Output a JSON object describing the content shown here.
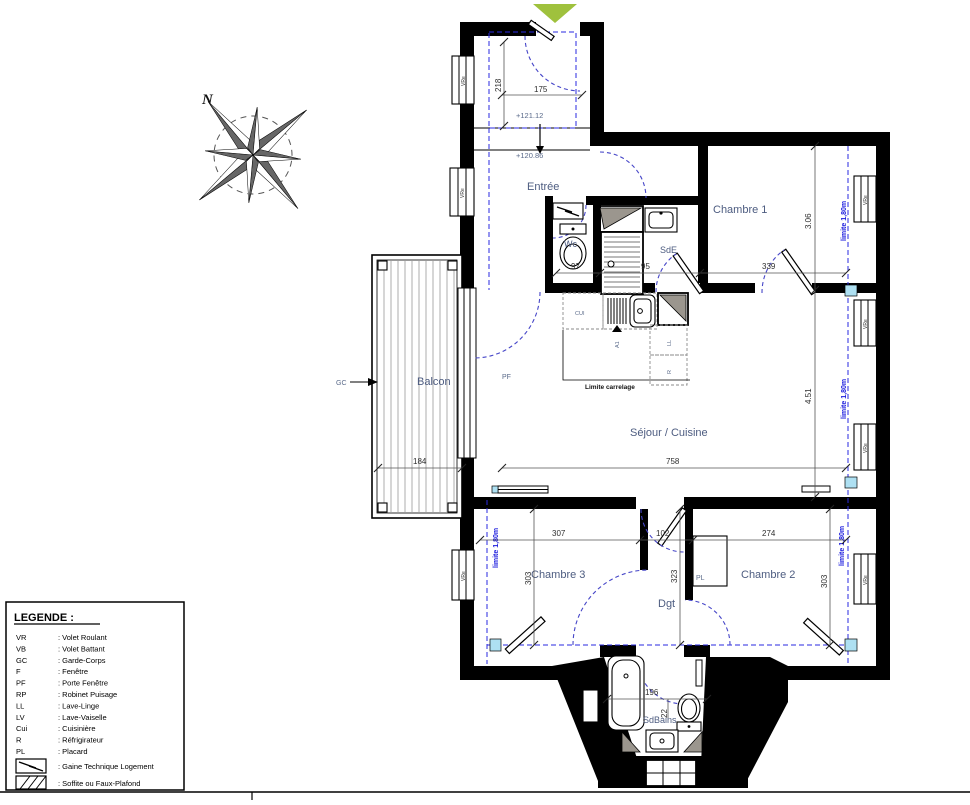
{
  "north": {
    "label": "N"
  },
  "colors": {
    "wall": "#000000",
    "room_label": "#4d5c80",
    "dimension_text": "#2e2e2e",
    "limite_blue": "#1818dd",
    "door_arc_blue": "#4646c8",
    "entrance_arrow_green": "#9fc13d",
    "soffite_gray": "#9b968e",
    "radiator_marker_blue": "#aee0f2"
  },
  "rooms": {
    "entree": "Entrée",
    "chambre1": "Chambre 1",
    "chambre2": "Chambre 2",
    "chambre3": "Chambre 3",
    "sejour": "Séjour / Cuisine",
    "sde": "SdE",
    "wc": "Wc",
    "sdbains": "SdBains",
    "balcon": "Balcon",
    "dgt": "Dgt"
  },
  "levels": {
    "upper": "+121.12",
    "lower": "+120.86"
  },
  "dims": {
    "entry_depth": "218",
    "entry_width": "175",
    "wc_width": "97",
    "shower_width": "95",
    "ch1_width": "339",
    "ch1_depth": "3.06",
    "sejour_width": "758",
    "sejour_depth": "4.51",
    "balcon_width": "184",
    "ch3_width": "307",
    "dgt_width": "102",
    "ch2_width": "274",
    "ch3_depth": "303",
    "dgt_depth": "323",
    "ch2_depth": "303",
    "sdb_width": "196",
    "sdb_toilet_gap": "22"
  },
  "annotations": {
    "gc": "GC",
    "pf": "PF",
    "window_shutter": "VRe",
    "cui": "CUI",
    "lave_linge": "LL",
    "refrigerateur": "R",
    "placard": "PL",
    "section_marker": "A1",
    "limite_carrelage": "Limite carrelage",
    "limite_180": "limite 1,80m"
  },
  "legend": {
    "title": "LEGENDE :",
    "items": [
      {
        "abbr": "VR",
        "label": ": Volet Roulant"
      },
      {
        "abbr": "VB",
        "label": ": Volet Battant"
      },
      {
        "abbr": "GC",
        "label": ": Garde-Corps"
      },
      {
        "abbr": "F",
        "label": ": Fenêtre"
      },
      {
        "abbr": "PF",
        "label": ": Porte Fenêtre"
      },
      {
        "abbr": "RP",
        "label": ": Robinet Puisage"
      },
      {
        "abbr": "LL",
        "label": ": Lave-Linge"
      },
      {
        "abbr": "LV",
        "label": ": Lave-Vaiselle"
      },
      {
        "abbr": "Cui",
        "label": ": Cuisinière"
      },
      {
        "abbr": "R",
        "label": ": Réfrigirateur"
      },
      {
        "abbr": "PL",
        "label": ": Placard"
      }
    ],
    "symbols": [
      {
        "label": ": Gaine Technique Logement"
      },
      {
        "label": ": Soffite ou Faux-Plafond"
      }
    ]
  }
}
